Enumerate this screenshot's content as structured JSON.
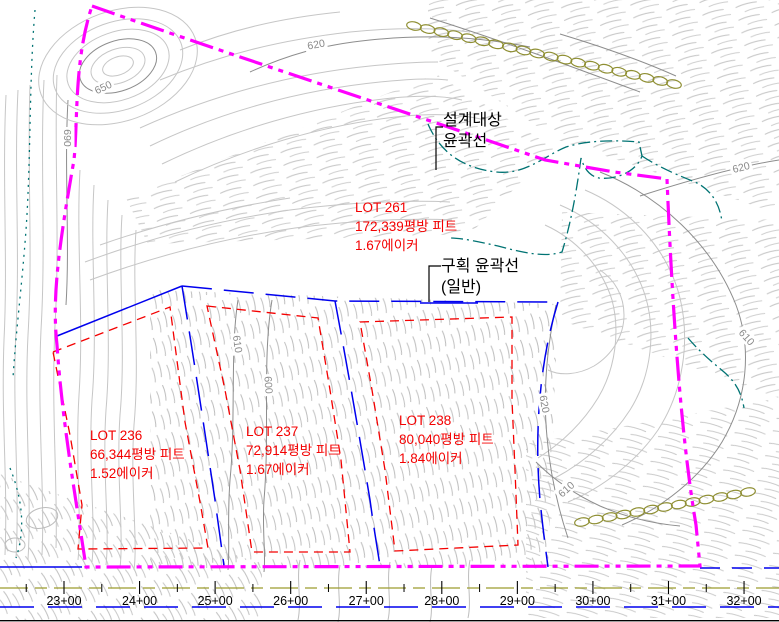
{
  "drawing": {
    "annotations": {
      "design_outline": {
        "line1": "설계대상",
        "line2": "윤곽선"
      },
      "parcel_outline": {
        "line1": "구획 윤곽선",
        "line2": "(일반)"
      }
    },
    "lots": [
      {
        "id": "LOT 261",
        "area": "172,339평방 피트",
        "acreage": "1.67에이커"
      },
      {
        "id": "LOT 236",
        "area": "66,344평방 피트",
        "acreage": "1.52에이커"
      },
      {
        "id": "LOT 237",
        "area": "72,914평방 피트",
        "acreage": "1.67에이커"
      },
      {
        "id": "LOT 238",
        "area": "80,040평방 피트",
        "acreage": "1.84에이커"
      }
    ],
    "stations": [
      "23+00",
      "24+00",
      "25+00",
      "26+00",
      "27+00",
      "28+00",
      "29+00",
      "30+00",
      "31+00",
      "32+00"
    ],
    "contour_labels": [
      "650",
      "620",
      "690",
      "620",
      "610",
      "600",
      "620",
      "610",
      "610"
    ],
    "colors": {
      "design_boundary": "#ff00ff",
      "parcel_outline": "#0000ee",
      "lot_lines": "#f40000",
      "contours_minor": "#c6c6c6",
      "contours_major": "#8d8d8d",
      "overlay_teal": "#007373",
      "centerline_olive": "#9c9c2e",
      "text_black": "#000000"
    }
  }
}
